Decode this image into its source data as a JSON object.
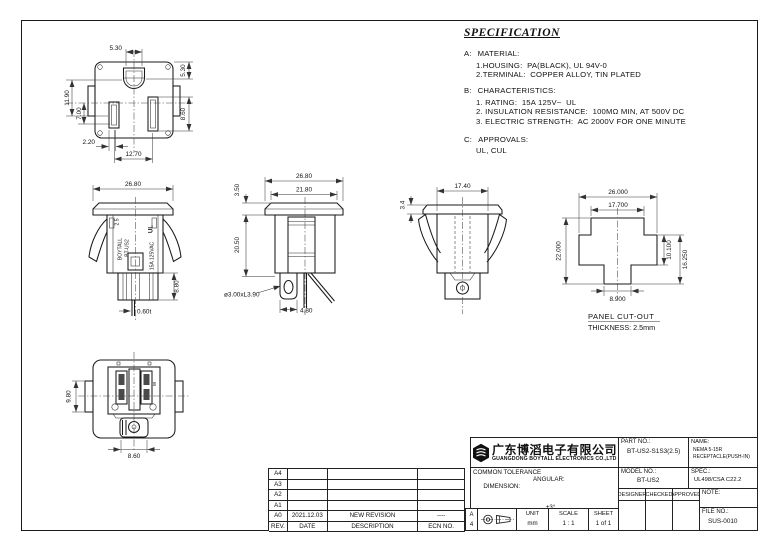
{
  "views": {
    "front": {
      "hole_w": "5.30",
      "right_top": "5.30",
      "left_outer": "11.90",
      "left_inner": "7.00",
      "right_slot": "8.60",
      "bottom_offset": "2.20",
      "bottom_span": "12.70"
    },
    "side_a": {
      "width": "26.80",
      "lower_h": "8.80",
      "pin_t": "0.60t",
      "brand": "BOYTALL",
      "model": "BT-US2",
      "wire": "2.5",
      "ul": "UL",
      "rating": "15A 125VAC"
    },
    "side_b": {
      "width": "26.80",
      "top_face": "21.80",
      "cap_h": "3.50",
      "body_h": "20.50",
      "hole": "ø3.00xL3.90",
      "foot_w": "4.80"
    },
    "side_c": {
      "width": "17.40",
      "cap_h": "3.4"
    },
    "cutout": {
      "outer_w": "26.000",
      "arm_w": "17.700",
      "height": "22.000",
      "mid_h": "10.100",
      "lower_h": "16.250",
      "stem_w": "8.900",
      "label": "PANEL CUT-OUT",
      "thickness": "THICKNESS: 2.5mm"
    },
    "rear": {
      "tab_h": "9.80",
      "foot_w": "8.60",
      "marking": "W"
    }
  },
  "spec": {
    "title": "SPECIFICATION",
    "sections": [
      {
        "label": "A:",
        "heading": "MATERIAL:",
        "items": [
          "1.HOUSING:  PA(BLACK), UL 94V-0",
          "2.TERMINAL:  COPPER ALLOY, TIN PLATED"
        ]
      },
      {
        "label": "B:",
        "heading": "CHARACTERISTICS:",
        "items": [
          "1. RATING:  15A 125V~  UL",
          "2. INSULATION RESISTANCE:  100MΩ MIN, AT 500V DC",
          "3. ELECTRIC STRENGTH:  AC 2000V FOR ONE MINUTE"
        ]
      },
      {
        "label": "C:",
        "heading": "APPROVALS:",
        "items": [
          "UL, CUL"
        ]
      }
    ]
  },
  "revision": {
    "headers": {
      "rev": "REV.",
      "date": "DATE",
      "description": "DESCRIPTION",
      "ecn": "ECN NO."
    },
    "rows": [
      {
        "rev": "A4",
        "date": "",
        "description": "",
        "ecn": ""
      },
      {
        "rev": "A3",
        "date": "",
        "description": "",
        "ecn": ""
      },
      {
        "rev": "A2",
        "date": "",
        "description": "",
        "ecn": ""
      },
      {
        "rev": "A1",
        "date": "",
        "description": "",
        "ecn": ""
      },
      {
        "rev": "A0",
        "date": "2021.12.03",
        "description": "NEW REVISION",
        "ecn": "----"
      }
    ]
  },
  "title_block": {
    "company_cn": "广东博滔电子有限公司",
    "company_en": "GUANGDONG BOYTALL ELECTRONICS CO.,LTD",
    "part_label": "PART NO.:",
    "part_value": "BT-US2-S1S3(2.5)",
    "name_label": "NAME:",
    "name_line1": "NEMA 5-15R",
    "name_line2": "RECEPTACLE(PUSH-IN)",
    "model_label": "MODEL NO.:",
    "model_value": "BT-US2",
    "spec_label": "SPEC.:",
    "spec_value": "UL498/CSA C22.2",
    "designer_label": "DESIGNER",
    "checked_label": "CHECKED",
    "approved_label": "APPROVED",
    "note_label": "NOTE:",
    "file_label": "FILE NO.:",
    "file_value": "SUS-0010",
    "tolerance_title": "COMMON TOLERANCE",
    "dimension_label": "DIMENSION:",
    "angular_label": "ANGULAR:",
    "tol_row1": ".000 : ±0.1",
    "tol_row2": ".00  : ±0.2",
    "tol_row3": ".0   : ±0.3",
    "angular_value": "±3°",
    "paper_a": "A",
    "paper_4": "4",
    "unit_label": "UNIT",
    "unit_value": "mm",
    "scale_label": "SCALE",
    "scale_value": "1 : 1",
    "sheet_label": "SHEET",
    "sheet_value": "1 of 1"
  }
}
